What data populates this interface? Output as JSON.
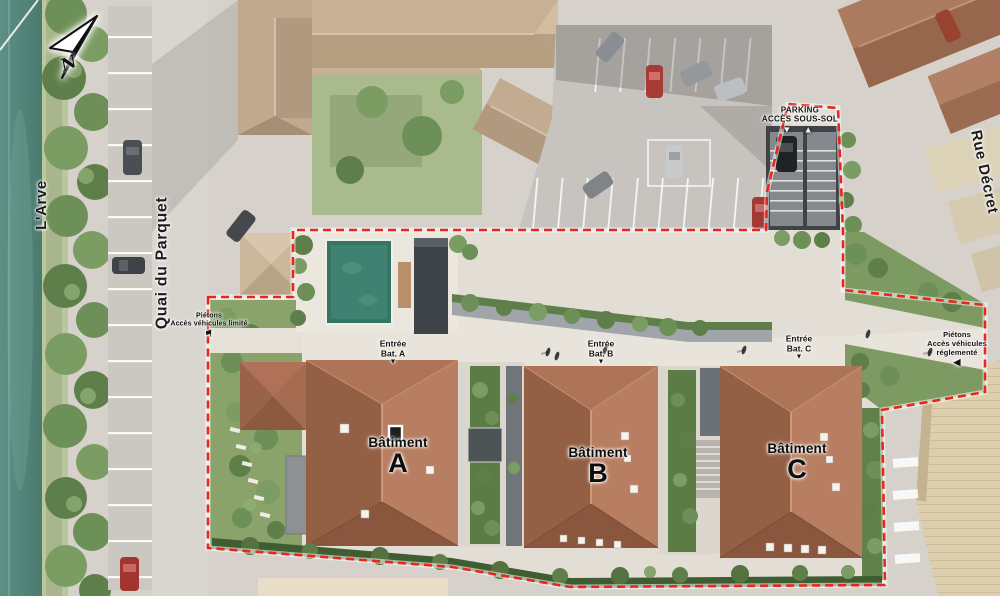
{
  "compass": {
    "letter": "N"
  },
  "streets": {
    "river": "L'Arve",
    "quai": "Quai du Parquet",
    "rue": "Rue Décret"
  },
  "parking_access": {
    "line1": "PARKING",
    "line2": "ACCÈS SOUS-SOL",
    "arrows": "▼ ▲"
  },
  "access_west": {
    "line1": "Piétons",
    "line2": "Accès véhicules limité",
    "marker": "⚑"
  },
  "access_east": {
    "line1": "Piétons",
    "line2": "Accès véhicules",
    "line3": "réglementé",
    "arrow": "◀"
  },
  "entrances": [
    {
      "line1": "Entrée",
      "line2": "Bat. A",
      "arrow": "▼"
    },
    {
      "line1": "Entrée",
      "line2": "Bat. B",
      "arrow": "▼"
    },
    {
      "line1": "Entrée",
      "line2": "Bat. C",
      "arrow": "▼"
    }
  ],
  "buildings": [
    {
      "name": "Bâtiment",
      "letter": "A"
    },
    {
      "name": "Bâtiment",
      "letter": "B"
    },
    {
      "name": "Bâtiment",
      "letter": "C"
    }
  ],
  "colors": {
    "boundary_red": "#e8261b",
    "water_teal": "#55857b",
    "new_roof_terracotta": "#a8694d",
    "existing_roof_tan": "#c3ac92",
    "pool_green": "#357564"
  }
}
